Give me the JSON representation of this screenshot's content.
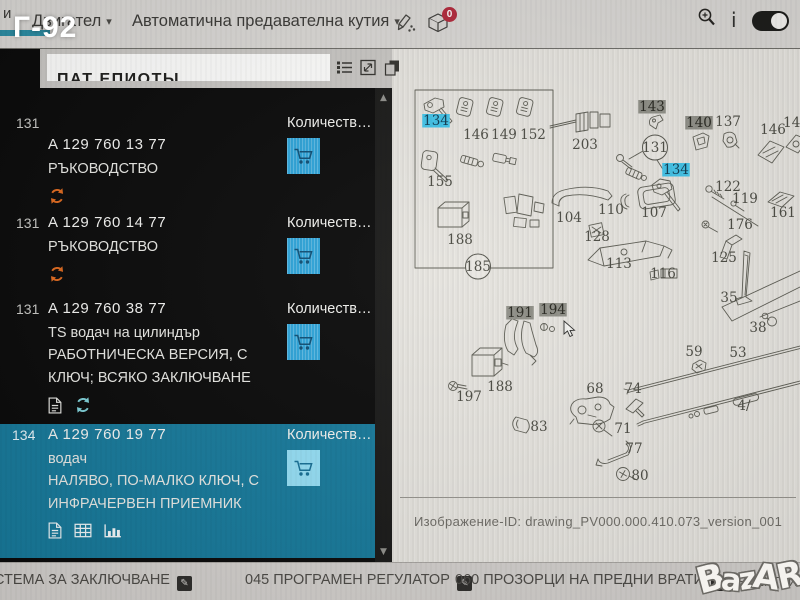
{
  "photo_overlay": {
    "label": "Г-92",
    "watermark": "BazAR"
  },
  "toolbar": {
    "tab_fragment": "и",
    "tab_engine": "Двигател",
    "tab_transmission": "Автоматична предавателна кутия",
    "basket_badge": "0"
  },
  "icons": {
    "caret_down": "▾",
    "scroll_up": "▲",
    "scroll_down": "▼",
    "edit": "✎",
    "info": "i"
  },
  "sidebar": {
    "header_fragment": "ПАТ ЕПИОТЫ",
    "quantity_label": "Количеств…",
    "rows": [
      {
        "pos": "131",
        "part_number": "A 129 760 13 77",
        "lines": [
          "РЪКОВОДСТВО"
        ]
      },
      {
        "pos": "131",
        "part_number": "A 129 760 14 77",
        "lines": [
          "РЪКОВОДСТВО"
        ]
      },
      {
        "pos": "131",
        "part_number": "A 129 760 38 77",
        "lines": [
          "TS водач на цилиндър",
          "РАБОТНИЧЕСКА ВЕРСИЯ, С",
          "КЛЮЧ; ВСЯКО ЗАКЛЮЧВАНЕ"
        ]
      },
      {
        "pos": "134",
        "part_number": "A 129 760 19 77",
        "lines": [
          "водач",
          "НАЛЯВО, ПО-МАЛКО КЛЮЧ, С",
          "ИНФРАЧЕРВЕН ПРИЕМНИК"
        ]
      }
    ]
  },
  "diagram": {
    "image_id": "Изображение-ID: drawing_PV000.000.410.073_version_001",
    "labels": [
      {
        "t": "134",
        "x": 44,
        "y": 70,
        "s": "blue"
      },
      {
        "t": "146",
        "x": 84,
        "y": 84,
        "s": "n"
      },
      {
        "t": "149",
        "x": 112,
        "y": 84,
        "s": "n"
      },
      {
        "t": "152",
        "x": 141,
        "y": 84,
        "s": "n"
      },
      {
        "t": "155",
        "x": 48,
        "y": 131,
        "s": "n"
      },
      {
        "t": "188",
        "x": 68,
        "y": 189,
        "s": "n"
      },
      {
        "t": "185",
        "x": 86,
        "y": 216,
        "s": "circle"
      },
      {
        "t": "203",
        "x": 193,
        "y": 94,
        "s": "n"
      },
      {
        "t": "143",
        "x": 260,
        "y": 56,
        "s": "gray"
      },
      {
        "t": "140",
        "x": 307,
        "y": 72,
        "s": "gray"
      },
      {
        "t": "137",
        "x": 336,
        "y": 71,
        "s": "n"
      },
      {
        "t": "131",
        "x": 263,
        "y": 97,
        "s": "circle"
      },
      {
        "t": "134",
        "x": 284,
        "y": 119,
        "s": "blue"
      },
      {
        "t": "146",
        "x": 381,
        "y": 79,
        "s": "n"
      },
      {
        "t": "149",
        "x": 404,
        "y": 72,
        "s": "n"
      },
      {
        "t": "122",
        "x": 336,
        "y": 136,
        "s": "n"
      },
      {
        "t": "119",
        "x": 353,
        "y": 148,
        "s": "n"
      },
      {
        "t": "161",
        "x": 391,
        "y": 162,
        "s": "n"
      },
      {
        "t": "176",
        "x": 348,
        "y": 174,
        "s": "n"
      },
      {
        "t": "125",
        "x": 332,
        "y": 207,
        "s": "n"
      },
      {
        "t": "104",
        "x": 177,
        "y": 167,
        "s": "n"
      },
      {
        "t": "110",
        "x": 219,
        "y": 159,
        "s": "n"
      },
      {
        "t": "107",
        "x": 262,
        "y": 162,
        "s": "n"
      },
      {
        "t": "128",
        "x": 205,
        "y": 186,
        "s": "n"
      },
      {
        "t": "113",
        "x": 227,
        "y": 213,
        "s": "n"
      },
      {
        "t": "116",
        "x": 271,
        "y": 223,
        "s": "n"
      },
      {
        "t": "35",
        "x": 337,
        "y": 247,
        "s": "n"
      },
      {
        "t": "38",
        "x": 366,
        "y": 277,
        "s": "n"
      },
      {
        "t": "53",
        "x": 346,
        "y": 302,
        "s": "n"
      },
      {
        "t": "4/",
        "x": 352,
        "y": 355,
        "s": "n"
      },
      {
        "t": "59",
        "x": 302,
        "y": 301,
        "s": "n"
      },
      {
        "t": "68",
        "x": 203,
        "y": 338,
        "s": "n"
      },
      {
        "t": "74",
        "x": 241,
        "y": 338,
        "s": "n"
      },
      {
        "t": "83",
        "x": 147,
        "y": 376,
        "s": "n"
      },
      {
        "t": "71",
        "x": 231,
        "y": 378,
        "s": "n"
      },
      {
        "t": "77",
        "x": 242,
        "y": 398,
        "s": "n"
      },
      {
        "t": "80",
        "x": 248,
        "y": 425,
        "s": "n"
      },
      {
        "t": "188",
        "x": 108,
        "y": 336,
        "s": "n"
      },
      {
        "t": "197",
        "x": 77,
        "y": 346,
        "s": "n"
      },
      {
        "t": "191",
        "x": 128,
        "y": 262,
        "s": "gray"
      },
      {
        "t": "194",
        "x": 161,
        "y": 259,
        "s": "gray"
      }
    ]
  },
  "bottombar": {
    "items": [
      "СТЕМА ЗА ЗАКЛЮЧВАНЕ",
      "045 ПРОГРАМЕН РЕГУЛАТОР",
      "060 ПРОЗОРЦИ НА ПРЕДНИ ВРАТИ"
    ],
    "fragment": "ЕЛЕКТРИЧЕ"
  },
  "colors": {
    "selected_row": "#17799a",
    "highlight_blue": "#41c3e8",
    "highlight_gray": "#8e8e86",
    "cart_blue": "#2da3d8",
    "refresh_orange": "#e06a1f",
    "refresh_teal": "#7fd0d8",
    "badge_red": "#b2293b"
  }
}
